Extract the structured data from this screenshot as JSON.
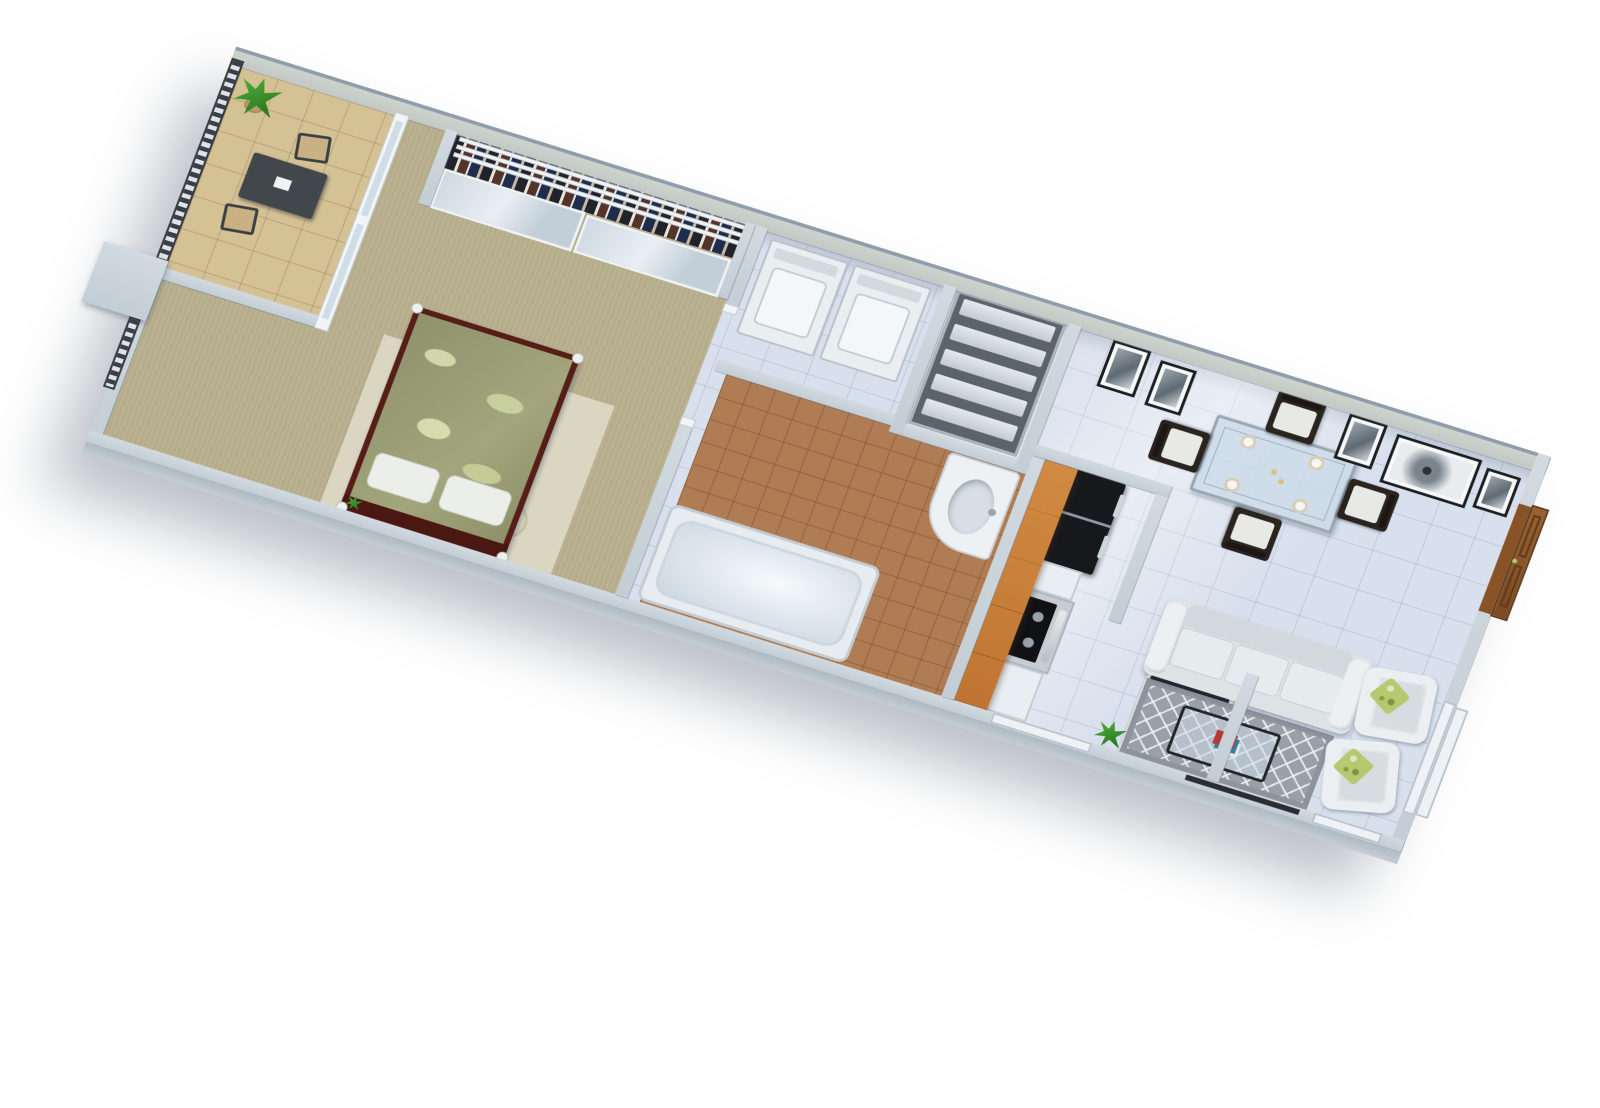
{
  "scene": {
    "label": "3D axonometric rendering of a one-bedroom apartment floor plan",
    "background": "#ffffff"
  },
  "palette": {
    "wall_top": "#cbd3da",
    "wall_face": "#a9b4bf",
    "wall_paint": "#c9cfc9",
    "floor_tile": "#d8e0ed",
    "bedroom_carpet": "#b5ac8a",
    "bathroom_tile": "#b07c54",
    "balcony_floor": "#d4c194",
    "cabinet_wood": "#c98038",
    "entry_door_wood": "#8a5327",
    "appliance_black": "#17181c",
    "sofa_fabric": "#dee3e6",
    "living_rug": "#99a0a8",
    "pillow_green": "#b7c86f",
    "duvet_green": "#999c74",
    "bed_frame": "#571e18",
    "railing_dark": "#3a4046"
  },
  "rooms": {
    "balcony": {
      "label": "balcony with desk nook"
    },
    "bedroom": {
      "label": "bedroom"
    },
    "closet": {
      "label": "closet with mirrored sliding doors"
    },
    "bathroom": {
      "label": "bathroom"
    },
    "laundry": {
      "label": "laundry nook"
    },
    "pantry": {
      "label": "linen shelving"
    },
    "kitchen": {
      "label": "galley kitchen"
    },
    "dining": {
      "label": "dining area"
    },
    "living": {
      "label": "living room"
    }
  },
  "items": {
    "bed": {
      "label": "double bed with leaf-print duvet",
      "pillows": 2
    },
    "bedroom_rug": {
      "label": "cream circle-pattern rug"
    },
    "closet_doors": {
      "label": "mirrored sliding doors",
      "panels": 2
    },
    "hanging_clothes": {
      "label": "hanging clothes"
    },
    "washer": {
      "label": "washer"
    },
    "dryer": {
      "label": "dryer"
    },
    "shelving": {
      "label": "shelving unit",
      "shelves": 5
    },
    "bathtub": {
      "label": "bathtub"
    },
    "vanity": {
      "label": "vanity sink"
    },
    "refrigerator": {
      "label": "black refrigerator"
    },
    "range": {
      "label": "gas range with oven"
    },
    "upper_cabinets": {
      "label": "wood upper cabinets"
    },
    "sink_island": {
      "label": "double-basin sink counter",
      "basins": 2
    },
    "dining_table": {
      "label": "glass dining table",
      "place_settings": 4
    },
    "dining_chairs": {
      "label": "dining chairs",
      "count": 4
    },
    "wall_art": {
      "label": "framed black-and-white art",
      "count": 5
    },
    "sofa": {
      "label": "three-seat sofa",
      "seats": 3
    },
    "coffee_table": {
      "label": "glass coffee table with magazines"
    },
    "living_rug": {
      "label": "gray trellis-pattern rug"
    },
    "armchairs": {
      "label": "armchairs",
      "count": 2
    },
    "throw_pillows": {
      "label": "green throw pillows",
      "count": 2
    },
    "entry_door": {
      "label": "wood entry door"
    },
    "window_right": {
      "label": "window"
    },
    "window_kitchen": {
      "label": "window"
    },
    "window_corner": {
      "label": "window"
    },
    "balcony_desk": {
      "label": "balcony desk"
    },
    "balcony_chairs": {
      "label": "balcony chairs",
      "count": 2
    },
    "railing": {
      "label": "balcony railing"
    },
    "plants": {
      "label": "potted plants",
      "count": 3
    },
    "sliding_door": {
      "label": "sliding glass door"
    }
  }
}
